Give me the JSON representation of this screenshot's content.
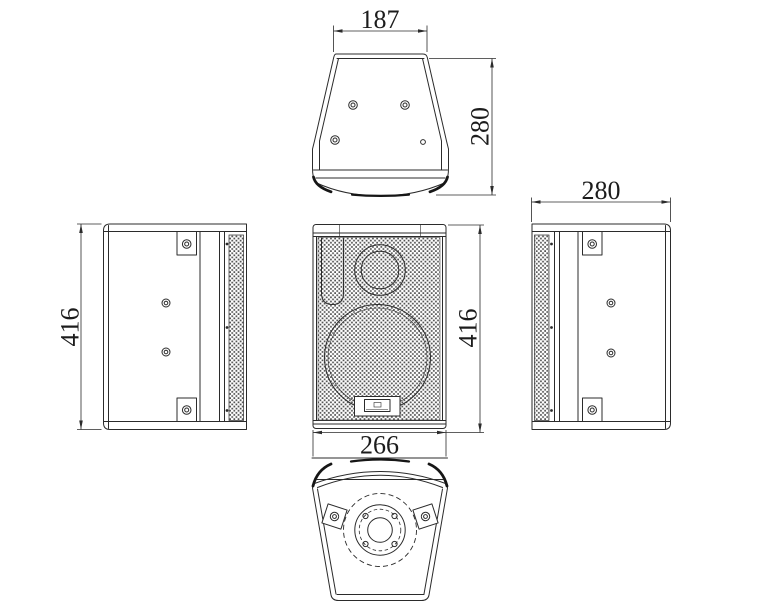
{
  "drawing": {
    "type": "speaker-cabinet-four-view-technical-drawing",
    "colors": {
      "background": "#ffffff",
      "line": "#2b2b2b",
      "mesh_dot": "#545454"
    },
    "dimensions": {
      "top_width": "187",
      "top_depth": "280",
      "left_height": "416",
      "front_height": "416",
      "front_width": "266",
      "right_depth": "280"
    }
  }
}
